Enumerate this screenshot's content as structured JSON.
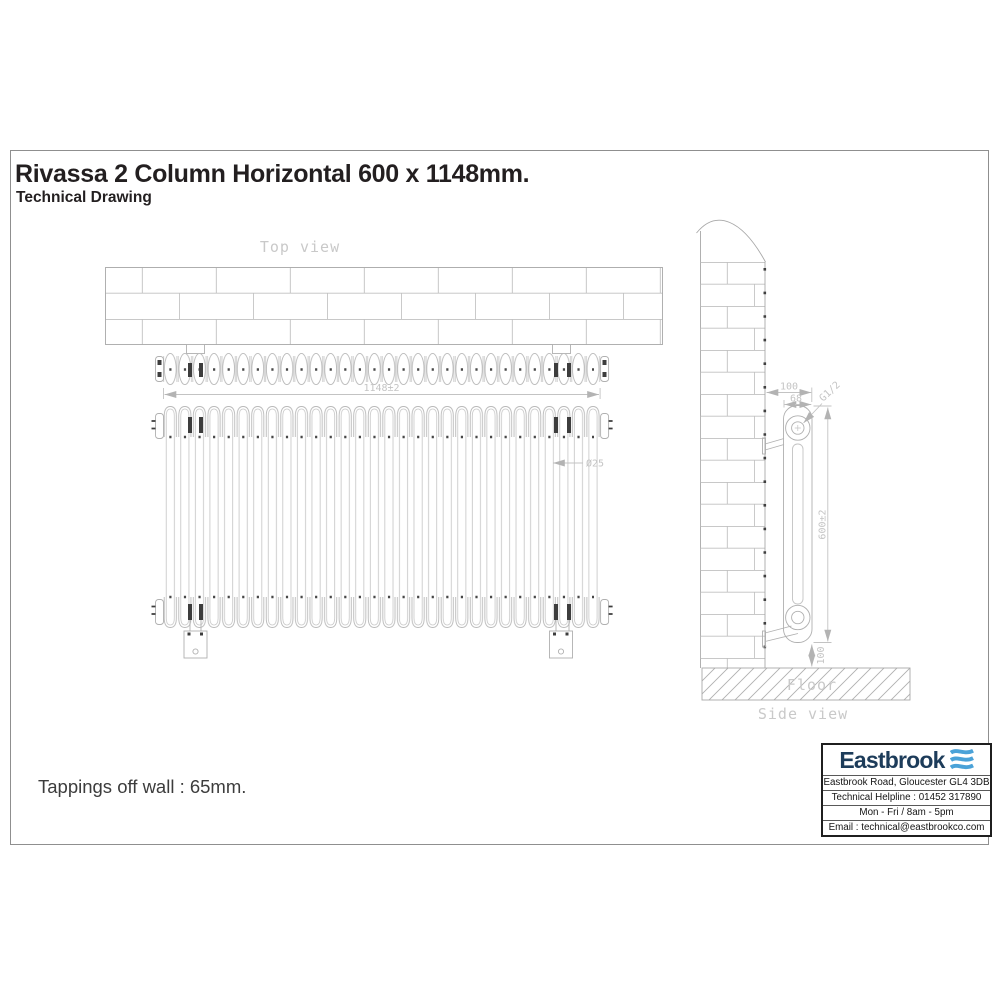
{
  "header": {
    "title": "Rivassa 2 Column Horizontal 600 x 1148mm.",
    "subtitle": "Technical Drawing"
  },
  "note": {
    "text": "Tappings off wall : 65mm."
  },
  "views": {
    "top": {
      "label": "Top view",
      "width_dim": "1148±2"
    },
    "front": {
      "diameter_dim": "Ø25"
    },
    "side": {
      "label": "Side view",
      "floor_label": "Floor",
      "off_wall_dim": "100",
      "depth_dim": "68",
      "tapping_dim": "G1/2",
      "height_dim": "600±2",
      "floor_gap_dim": "100"
    }
  },
  "footer": {
    "brand": "Eastbrook",
    "address": "Eastbrook Road, Gloucester GL4 3DB",
    "helpline": "Technical Helpline : 01452 317890",
    "hours": "Mon - Fri / 8am - 5pm",
    "email": "Email : technical@eastbrookco.com"
  },
  "colors": {
    "brand_navy": "#1d3c5a",
    "brand_blue": "#4aa2d8",
    "line_gray": "#b9b9b9",
    "label_gray": "#c6c6c6",
    "dark_mark": "#3d3d3d"
  }
}
